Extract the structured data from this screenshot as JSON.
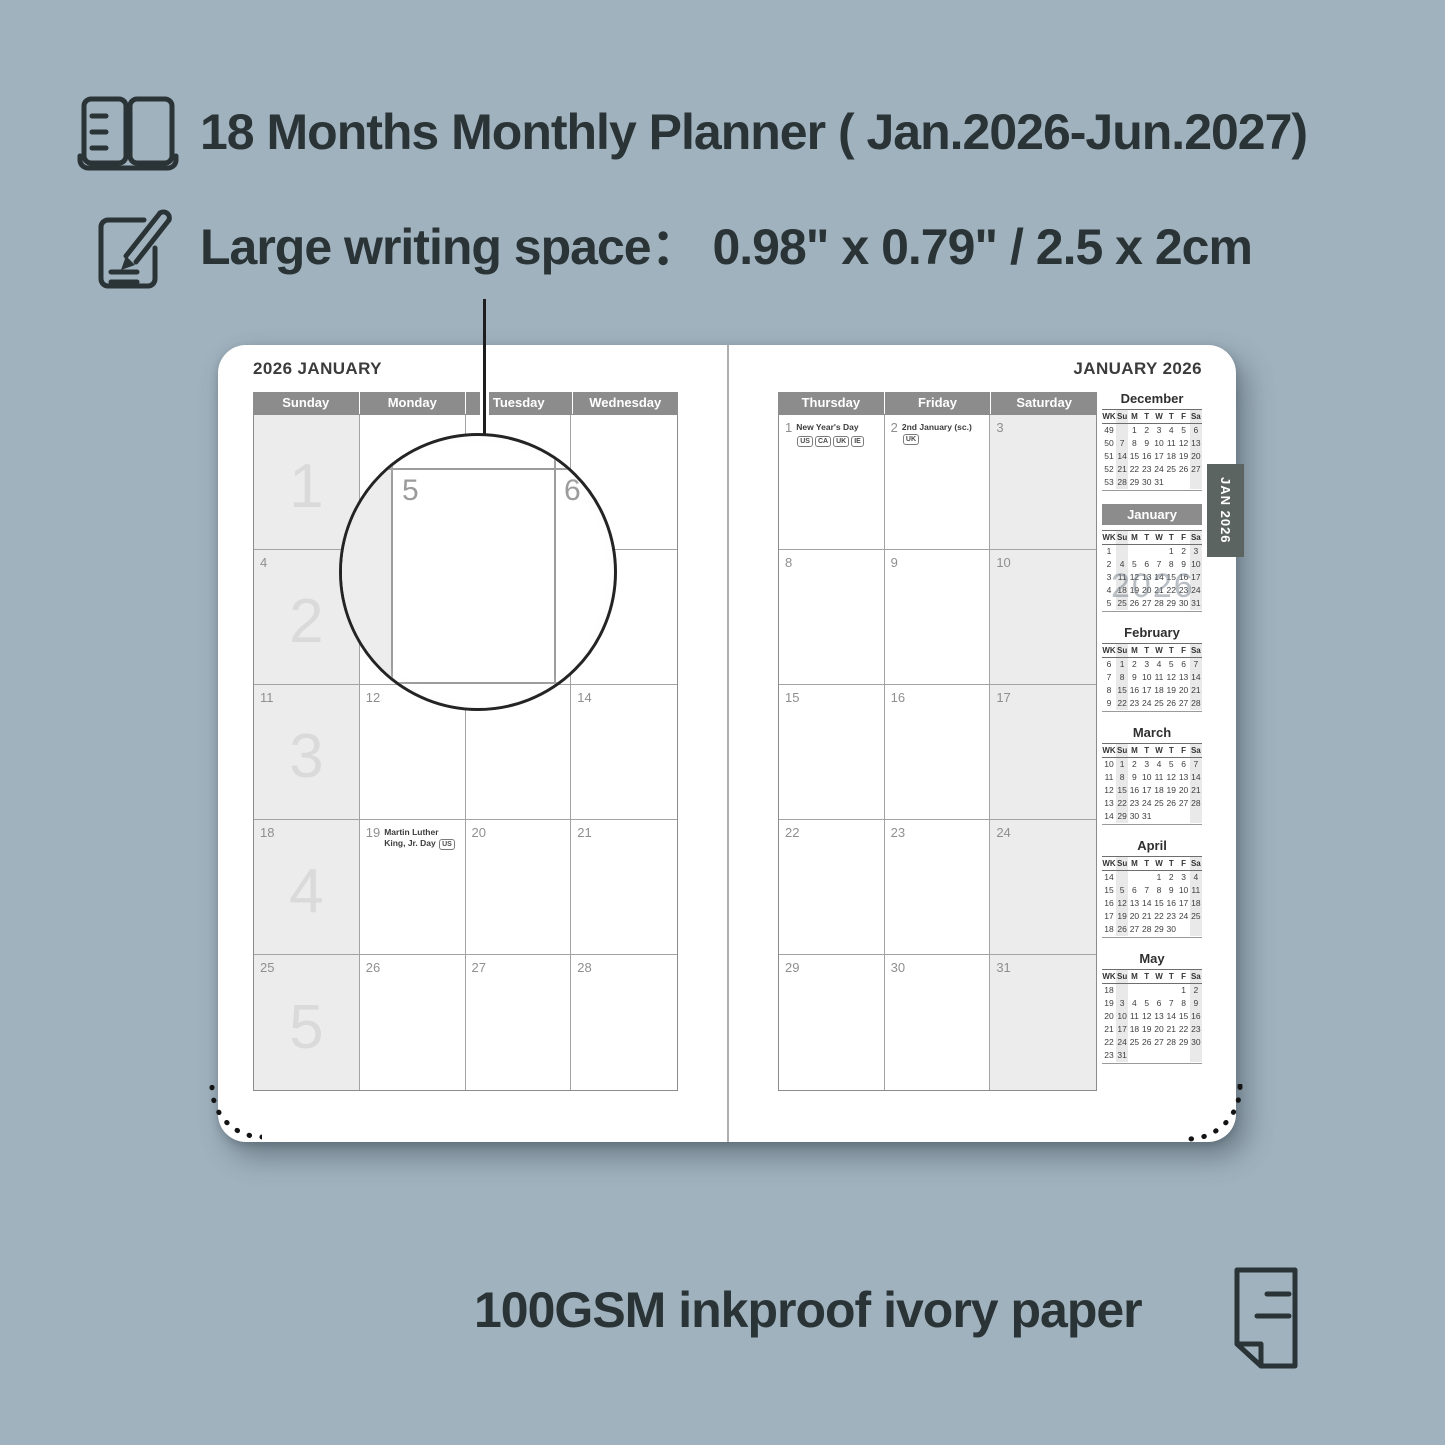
{
  "background_color": "#a0b2be",
  "accent_text_color": "#2a3336",
  "features": {
    "months": {
      "icon": "open-book-icon",
      "text": "18 Months Monthly Planner ( Jan.2026-Jun.2027)"
    },
    "writing": {
      "icon": "pencil-note-icon",
      "text": "Large writing space：  0.98\" x 0.79\" / 2.5 x 2cm"
    },
    "paper": {
      "icon": "paper-sheet-icon",
      "text": "100GSM inkproof ivory paper"
    }
  },
  "magnifier": {
    "left_date": "5",
    "right_date": "6"
  },
  "planner": {
    "tab_label": "JAN 2026",
    "watermark": "2026",
    "left_page": {
      "title": "2026 JANUARY",
      "day_headers": [
        "Sunday",
        "Monday",
        "Tuesday",
        "Wednesday"
      ],
      "rows": [
        [
          {
            "week": "1"
          },
          {},
          {},
          {}
        ],
        [
          {
            "date": "4",
            "week": "2"
          },
          {},
          {},
          {}
        ],
        [
          {
            "date": "11",
            "week": "3"
          },
          {
            "date": "12"
          },
          {},
          {
            "date": "14"
          }
        ],
        [
          {
            "date": "18",
            "week": "4"
          },
          {
            "date": "19",
            "holiday": "Martin Luther King, Jr. Day",
            "badges": [
              "US"
            ]
          },
          {
            "date": "20"
          },
          {
            "date": "21"
          }
        ],
        [
          {
            "date": "25",
            "week": "5"
          },
          {
            "date": "26"
          },
          {
            "date": "27"
          },
          {
            "date": "28"
          }
        ]
      ]
    },
    "right_page": {
      "title": "JANUARY 2026",
      "day_headers": [
        "Thursday",
        "Friday",
        "Saturday"
      ],
      "rows": [
        [
          {
            "date": "1",
            "holiday": "New Year's Day",
            "badges": [
              "US",
              "CA",
              "UK",
              "IE"
            ],
            "badges_below": true
          },
          {
            "date": "2",
            "holiday": "2nd January (sc.)",
            "badges": [
              "UK"
            ]
          },
          {
            "date": "3"
          }
        ],
        [
          {
            "date": "8"
          },
          {
            "date": "9"
          },
          {
            "date": "10"
          }
        ],
        [
          {
            "date": "15"
          },
          {
            "date": "16"
          },
          {
            "date": "17"
          }
        ],
        [
          {
            "date": "22"
          },
          {
            "date": "23"
          },
          {
            "date": "24"
          }
        ],
        [
          {
            "date": "29"
          },
          {
            "date": "30"
          },
          {
            "date": "31"
          }
        ]
      ]
    },
    "mini_calendars": {
      "weekday_headers": [
        "WK",
        "Su",
        "M",
        "T",
        "W",
        "T",
        "F",
        "Sa"
      ],
      "months": [
        {
          "name": "December",
          "highlight": false,
          "weeks": [
            {
              "wk": "49",
              "days": [
                "",
                "1",
                "2",
                "3",
                "4",
                "5",
                "6"
              ]
            },
            {
              "wk": "50",
              "days": [
                "7",
                "8",
                "9",
                "10",
                "11",
                "12",
                "13"
              ]
            },
            {
              "wk": "51",
              "days": [
                "14",
                "15",
                "16",
                "17",
                "18",
                "19",
                "20"
              ]
            },
            {
              "wk": "52",
              "days": [
                "21",
                "22",
                "23",
                "24",
                "25",
                "26",
                "27"
              ]
            },
            {
              "wk": "53",
              "days": [
                "28",
                "29",
                "30",
                "31",
                "",
                "",
                ""
              ]
            }
          ]
        },
        {
          "name": "January",
          "highlight": true,
          "weeks": [
            {
              "wk": "1",
              "days": [
                "",
                "",
                "",
                "",
                "1",
                "2",
                "3"
              ]
            },
            {
              "wk": "2",
              "days": [
                "4",
                "5",
                "6",
                "7",
                "8",
                "9",
                "10"
              ]
            },
            {
              "wk": "3",
              "days": [
                "11",
                "12",
                "13",
                "14",
                "15",
                "16",
                "17"
              ]
            },
            {
              "wk": "4",
              "days": [
                "18",
                "19",
                "20",
                "21",
                "22",
                "23",
                "24"
              ]
            },
            {
              "wk": "5",
              "days": [
                "25",
                "26",
                "27",
                "28",
                "29",
                "30",
                "31"
              ]
            }
          ]
        },
        {
          "name": "February",
          "highlight": false,
          "weeks": [
            {
              "wk": "6",
              "days": [
                "1",
                "2",
                "3",
                "4",
                "5",
                "6",
                "7"
              ]
            },
            {
              "wk": "7",
              "days": [
                "8",
                "9",
                "10",
                "11",
                "12",
                "13",
                "14"
              ]
            },
            {
              "wk": "8",
              "days": [
                "15",
                "16",
                "17",
                "18",
                "19",
                "20",
                "21"
              ]
            },
            {
              "wk": "9",
              "days": [
                "22",
                "23",
                "24",
                "25",
                "26",
                "27",
                "28"
              ]
            }
          ]
        },
        {
          "name": "March",
          "highlight": false,
          "weeks": [
            {
              "wk": "10",
              "days": [
                "1",
                "2",
                "3",
                "4",
                "5",
                "6",
                "7"
              ]
            },
            {
              "wk": "11",
              "days": [
                "8",
                "9",
                "10",
                "11",
                "12",
                "13",
                "14"
              ]
            },
            {
              "wk": "12",
              "days": [
                "15",
                "16",
                "17",
                "18",
                "19",
                "20",
                "21"
              ]
            },
            {
              "wk": "13",
              "days": [
                "22",
                "23",
                "24",
                "25",
                "26",
                "27",
                "28"
              ]
            },
            {
              "wk": "14",
              "days": [
                "29",
                "30",
                "31",
                "",
                "",
                "",
                ""
              ]
            }
          ]
        },
        {
          "name": "April",
          "highlight": false,
          "weeks": [
            {
              "wk": "14",
              "days": [
                "",
                "",
                "",
                "1",
                "2",
                "3",
                "4"
              ]
            },
            {
              "wk": "15",
              "days": [
                "5",
                "6",
                "7",
                "8",
                "9",
                "10",
                "11"
              ]
            },
            {
              "wk": "16",
              "days": [
                "12",
                "13",
                "14",
                "15",
                "16",
                "17",
                "18"
              ]
            },
            {
              "wk": "17",
              "days": [
                "19",
                "20",
                "21",
                "22",
                "23",
                "24",
                "25"
              ]
            },
            {
              "wk": "18",
              "days": [
                "26",
                "27",
                "28",
                "29",
                "30",
                "",
                ""
              ]
            }
          ]
        },
        {
          "name": "May",
          "highlight": false,
          "weeks": [
            {
              "wk": "18",
              "days": [
                "",
                "",
                "",
                "",
                "",
                "1",
                "2"
              ]
            },
            {
              "wk": "19",
              "days": [
                "3",
                "4",
                "5",
                "6",
                "7",
                "8",
                "9"
              ]
            },
            {
              "wk": "20",
              "days": [
                "10",
                "11",
                "12",
                "13",
                "14",
                "15",
                "16"
              ]
            },
            {
              "wk": "21",
              "days": [
                "17",
                "18",
                "19",
                "20",
                "21",
                "22",
                "23"
              ]
            },
            {
              "wk": "22",
              "days": [
                "24",
                "25",
                "26",
                "27",
                "28",
                "29",
                "30"
              ]
            },
            {
              "wk": "23",
              "days": [
                "31",
                "",
                "",
                "",
                "",
                "",
                ""
              ]
            }
          ]
        }
      ]
    }
  }
}
